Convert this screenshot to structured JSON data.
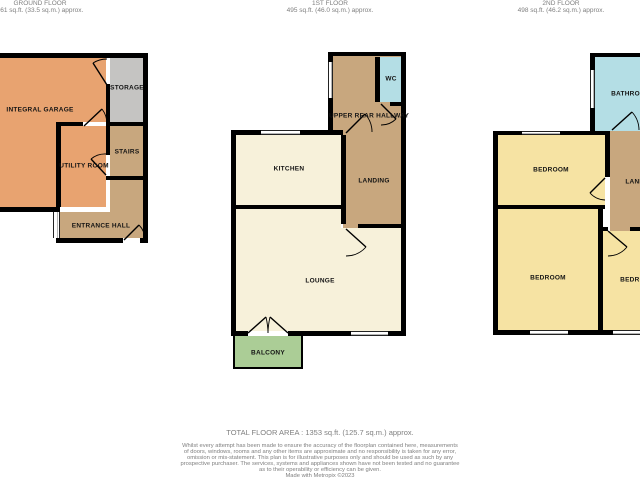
{
  "document": {
    "kind": "floorplan"
  },
  "colors": {
    "garage": "#E8A370",
    "storage": "#C5C4C2",
    "tan": "#C8A77E",
    "cream": "#F7F1DA",
    "blue": "#B4DEE5",
    "yellow": "#F6E3A3",
    "green": "#ABCD96",
    "wall": "#000000",
    "header_text": "#7F7F7F"
  },
  "floors": [
    {
      "id": "ground-floor",
      "title": "GROUND FLOOR",
      "area": "361 sq.ft. (33.5 sq.m.) approx.",
      "rooms": [
        {
          "label": "INTEGRAL GARAGE"
        },
        {
          "label": "STORAGE"
        },
        {
          "label": "STAIRS"
        },
        {
          "label": "UTILITY ROOM"
        },
        {
          "label": "ENTRANCE HALL"
        }
      ]
    },
    {
      "id": "first-floor",
      "title": "1ST FLOOR",
      "area": "495 sq.ft. (46.0 sq.m.) approx.",
      "rooms": [
        {
          "label": "UPPER REAR HALLWAY"
        },
        {
          "label": "WC"
        },
        {
          "label": "KITCHEN"
        },
        {
          "label": "LANDING"
        },
        {
          "label": "LOUNGE"
        },
        {
          "label": "BALCONY"
        }
      ]
    },
    {
      "id": "second-floor",
      "title": "2ND FLOOR",
      "area": "498 sq.ft. (46.2 sq.m.) approx.",
      "rooms": [
        {
          "label": "BATHROOM"
        },
        {
          "label": "BEDROOM"
        },
        {
          "label": "LANDING"
        },
        {
          "label": "BEDROOM"
        },
        {
          "label": "BEDROOM"
        }
      ]
    }
  ],
  "footer": {
    "total_area": "TOTAL FLOOR AREA : 1353 sq.ft. (125.7 sq.m.) approx.",
    "disclaimer_lines": [
      "Whilst every attempt has been made to ensure the accuracy of the floorplan contained here, measurements",
      "of doors, windows, rooms and any other items are approximate and no responsibility is taken for any error,",
      "omission or mis-statement. This plan is for illustrative purposes only and should be used as such by any",
      "prospective purchaser. The services, systems and appliances shown have not been tested and no guarantee",
      "as to their operability or efficiency can be given."
    ],
    "credit": "Made with Metropix ©2023"
  }
}
